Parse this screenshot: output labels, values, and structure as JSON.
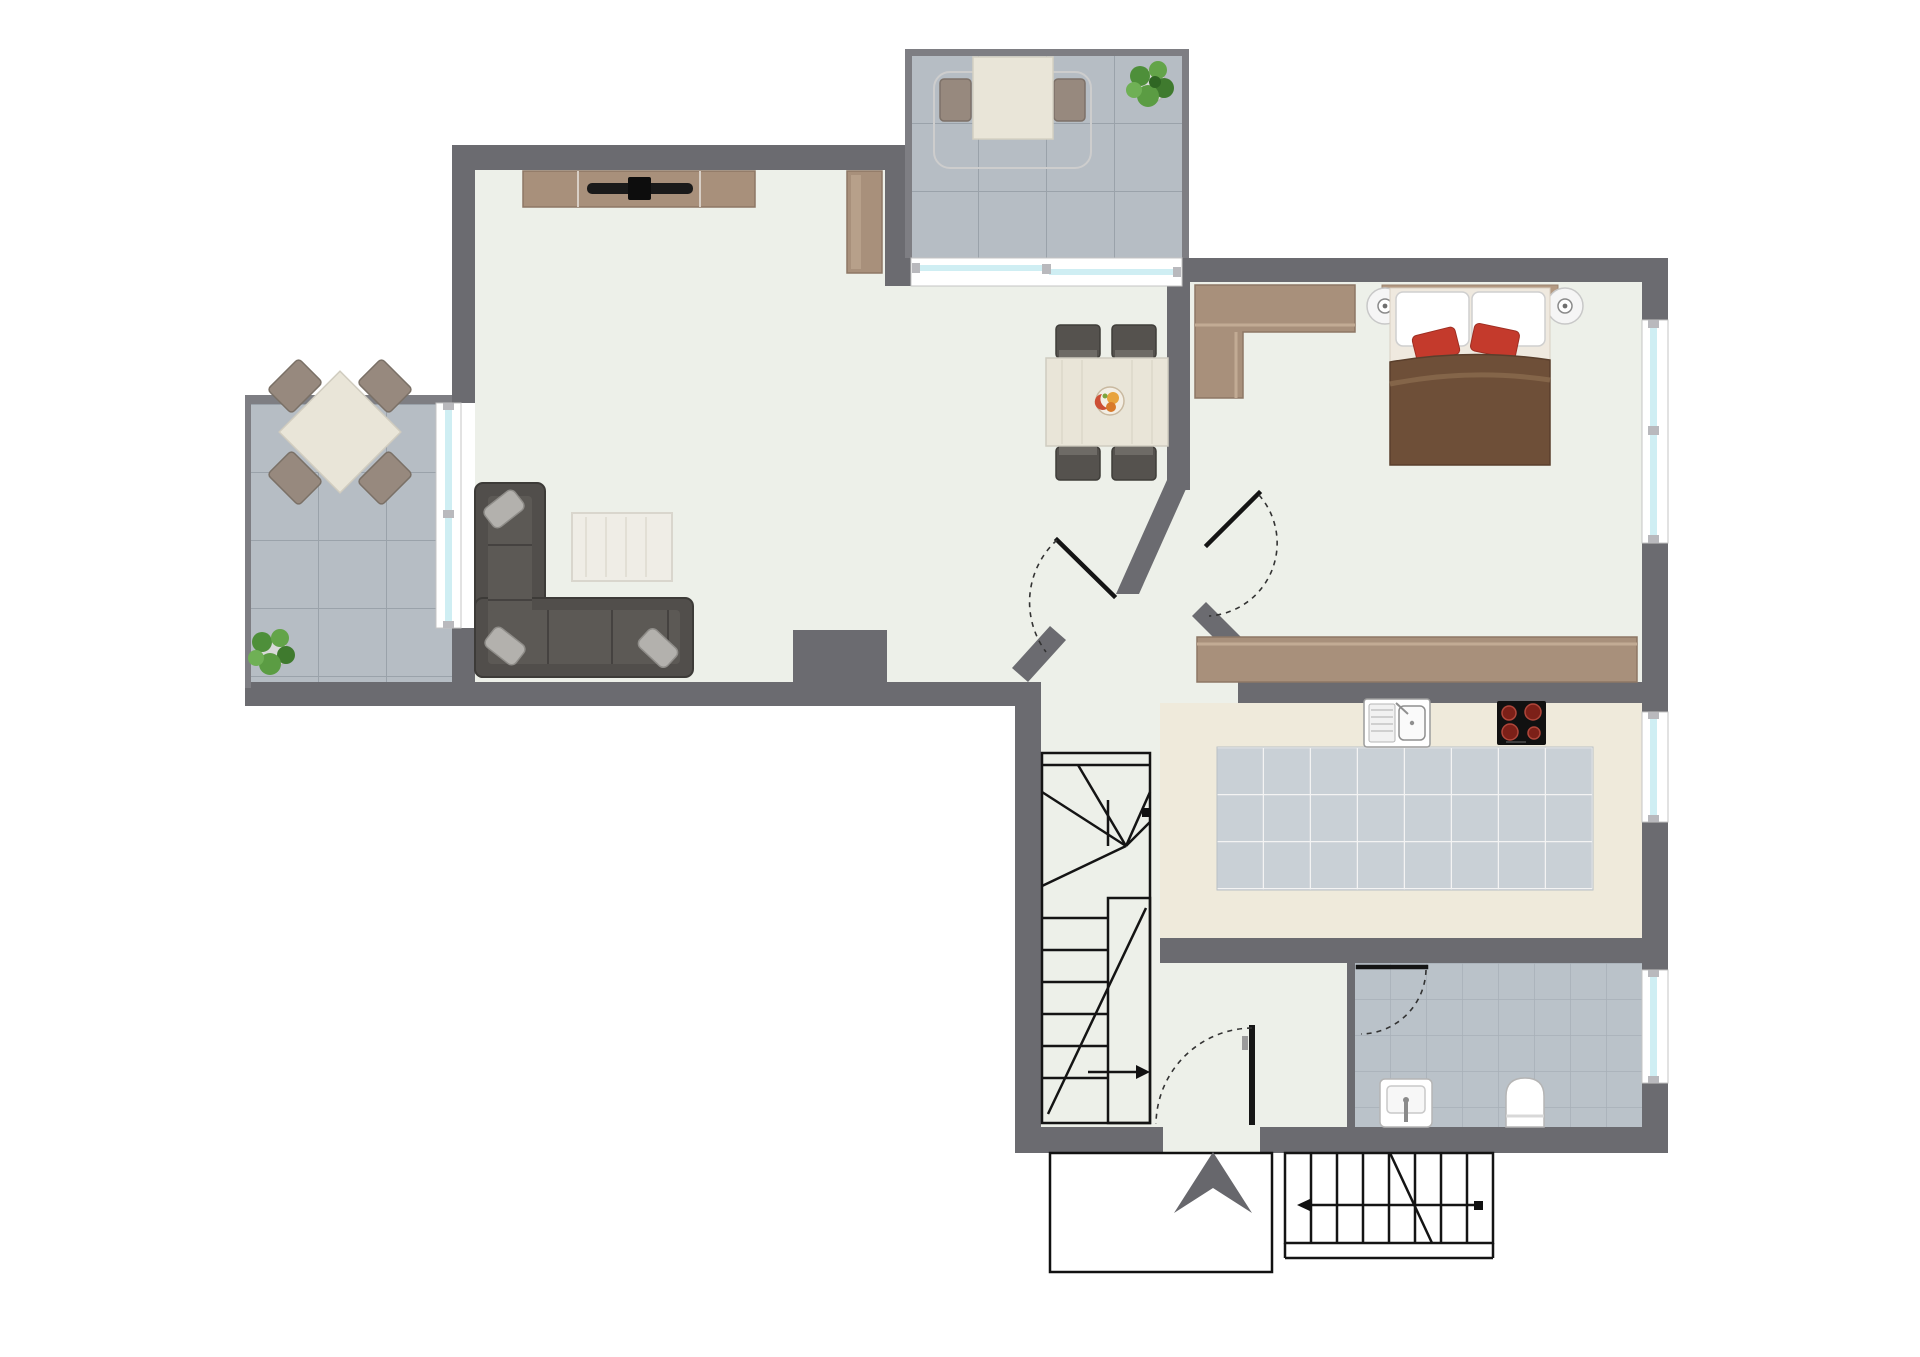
{
  "title": "apartment-floor-plan",
  "colors": {
    "wall": "#6b6b70",
    "wallThin": "#7e7e83",
    "floor": "#edf0e9",
    "kitchenFloor": "#efeadb",
    "tileTerrace": "#b6bdc4",
    "tileTerraceLine": "#9aa2aa",
    "tileKitchen": "#c9d0d6",
    "tileKitchenLine": "#f3f3f3",
    "tileBath": "#bac2c9",
    "tileBathLine": "#a8b0b7",
    "glass": "#cfeef3",
    "windowFrame": "#c4c4c4",
    "wood": "#a8907b",
    "woodDark": "#8d7765",
    "woodLight": "#c2ab94",
    "sofa": "#514e4b",
    "sofaDark": "#3d3b38",
    "sofaSeat": "#5c5955",
    "cushion": "#b3b1ad",
    "cream": "#e9e5d8",
    "creamEdge": "#cfccc0",
    "blanket": "#6e4f38",
    "redPillow": "#c43a2c",
    "chairDark": "#55524e",
    "chairTerrace": "#97897e",
    "line": "#141414",
    "doorArc": "#333333",
    "arrowGray": "#67676c",
    "plantGreen": "#5b9c43",
    "plantDark": "#3f7a2e",
    "white": "#ffffff"
  },
  "plan": {
    "canvas": {
      "width": 1920,
      "height": 1357
    },
    "rooms": [
      {
        "name": "living-dining-area",
        "floor": "light"
      },
      {
        "name": "bedroom",
        "floor": "light"
      },
      {
        "name": "kitchen",
        "floor": "cream-with-tiles"
      },
      {
        "name": "bathroom",
        "floor": "gray-tiles"
      },
      {
        "name": "hallway-stairwell",
        "floor": "light"
      },
      {
        "name": "terrace-top",
        "floor": "gray-tiles"
      },
      {
        "name": "terrace-left",
        "floor": "gray-tiles"
      }
    ],
    "furniture": [
      "tv-sideboard",
      "tall-cabinet",
      "corner-sofa",
      "rug",
      "dining-table-with-four-chairs",
      "fruit-bowl",
      "double-bed",
      "bedside-lamps",
      "wardrobe-l-shaped",
      "wardrobe-low",
      "kitchen-sink",
      "cooktop-four-burners",
      "bathroom-sink",
      "toilet",
      "terrace-table-two-chairs",
      "terrace-table-four-chairs",
      "potted-plant-top-terrace",
      "potted-plant-left-terrace"
    ],
    "features": [
      "interior-winder-staircase",
      "exterior-entry-stairs",
      "entry-porch-outline",
      "entrance-arrow-marker",
      "sliding-glass-door-top-terrace",
      "glass-door-left-terrace",
      "bedroom-window",
      "kitchen-window",
      "bathroom-window",
      "entry-door-swing",
      "bedroom-door-swing",
      "hall-door-swing",
      "bathroom-door-swing"
    ]
  }
}
